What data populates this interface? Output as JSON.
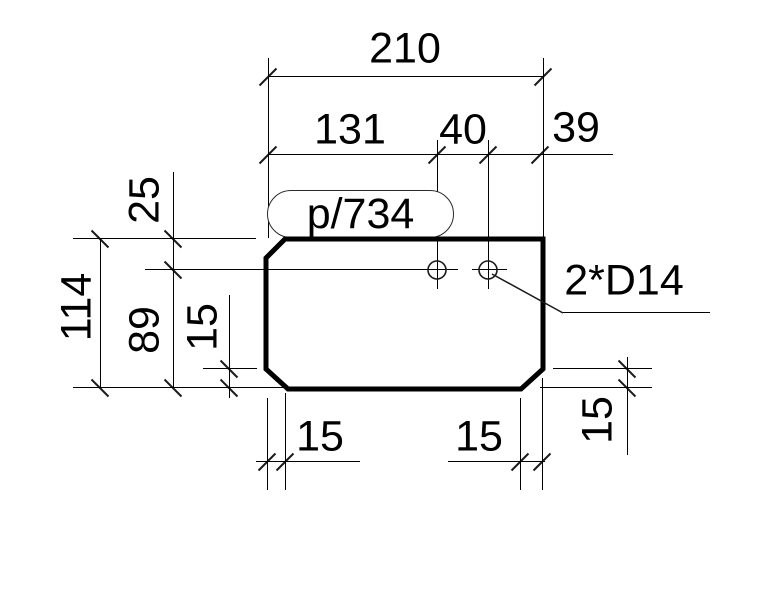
{
  "drawing": {
    "part_label": "p/734",
    "holes_note": "2*D14",
    "dims": {
      "overall_width": "210",
      "hole_left": "131",
      "hole_pitch": "40",
      "right_margin": "39",
      "hole_top": "25",
      "overall_height": "114",
      "below_holes": "89",
      "chamfer_left": "15",
      "chamfer_bottom_left": "15",
      "chamfer_bottom_right": "15",
      "chamfer_right": "15"
    },
    "colors": {
      "line": "#000000",
      "background": "#ffffff"
    }
  }
}
